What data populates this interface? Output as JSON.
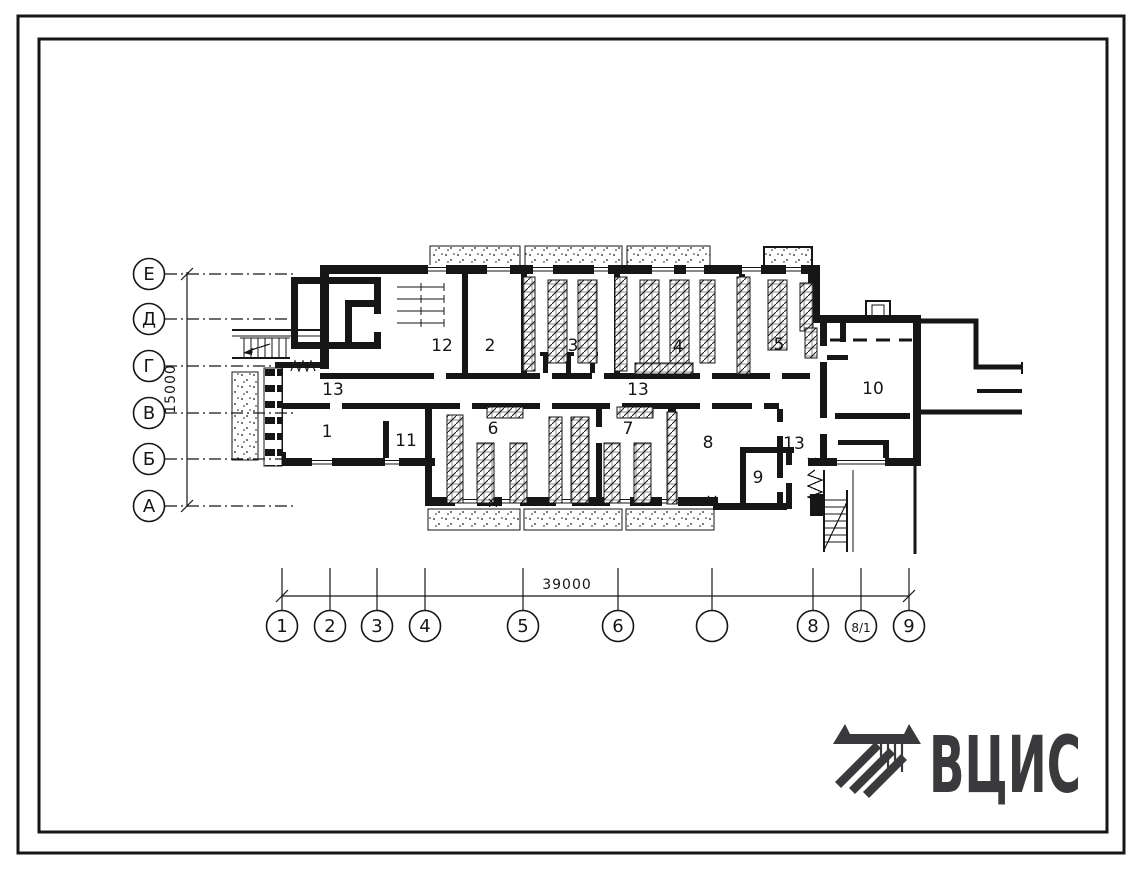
{
  "page": {
    "background": "#ffffff",
    "ink": "#161616",
    "logo_color": "#3a3a3c"
  },
  "plan": {
    "row_axes": [
      {
        "label": "Е",
        "y": 274
      },
      {
        "label": "Д",
        "y": 319
      },
      {
        "label": "Г",
        "y": 366
      },
      {
        "label": "В",
        "y": 413
      },
      {
        "label": "Б",
        "y": 459
      },
      {
        "label": "А",
        "y": 506
      }
    ],
    "row_dim": {
      "label": "15000"
    },
    "col_axes": [
      {
        "label": "1",
        "x": 282
      },
      {
        "label": "2",
        "x": 330
      },
      {
        "label": "3",
        "x": 377
      },
      {
        "label": "4",
        "x": 425
      },
      {
        "label": "5",
        "x": 523
      },
      {
        "label": "6",
        "x": 618
      },
      {
        "label": "",
        "x": 712
      },
      {
        "label": "8",
        "x": 813
      },
      {
        "label": "8/1",
        "x": 861
      },
      {
        "label": "9",
        "x": 909
      }
    ],
    "col_dim": {
      "label": "39000"
    },
    "room_labels": [
      {
        "label": "1",
        "x": 327,
        "y": 437
      },
      {
        "label": "2",
        "x": 490,
        "y": 351
      },
      {
        "label": "3",
        "x": 573,
        "y": 351
      },
      {
        "label": "4",
        "x": 678,
        "y": 352
      },
      {
        "label": "5",
        "x": 779,
        "y": 350
      },
      {
        "label": "6",
        "x": 493,
        "y": 434
      },
      {
        "label": "7",
        "x": 628,
        "y": 434
      },
      {
        "label": "8",
        "x": 708,
        "y": 448
      },
      {
        "label": "9",
        "x": 758,
        "y": 483
      },
      {
        "label": "10",
        "x": 873,
        "y": 394
      },
      {
        "label": "11",
        "x": 406,
        "y": 446
      },
      {
        "label": "12",
        "x": 442,
        "y": 351
      },
      {
        "label": "13",
        "x": 333,
        "y": 395
      },
      {
        "label": "13",
        "x": 638,
        "y": 395
      },
      {
        "label": "13",
        "x": 794,
        "y": 449
      }
    ]
  },
  "logo": {
    "text": "ВЦИС"
  }
}
